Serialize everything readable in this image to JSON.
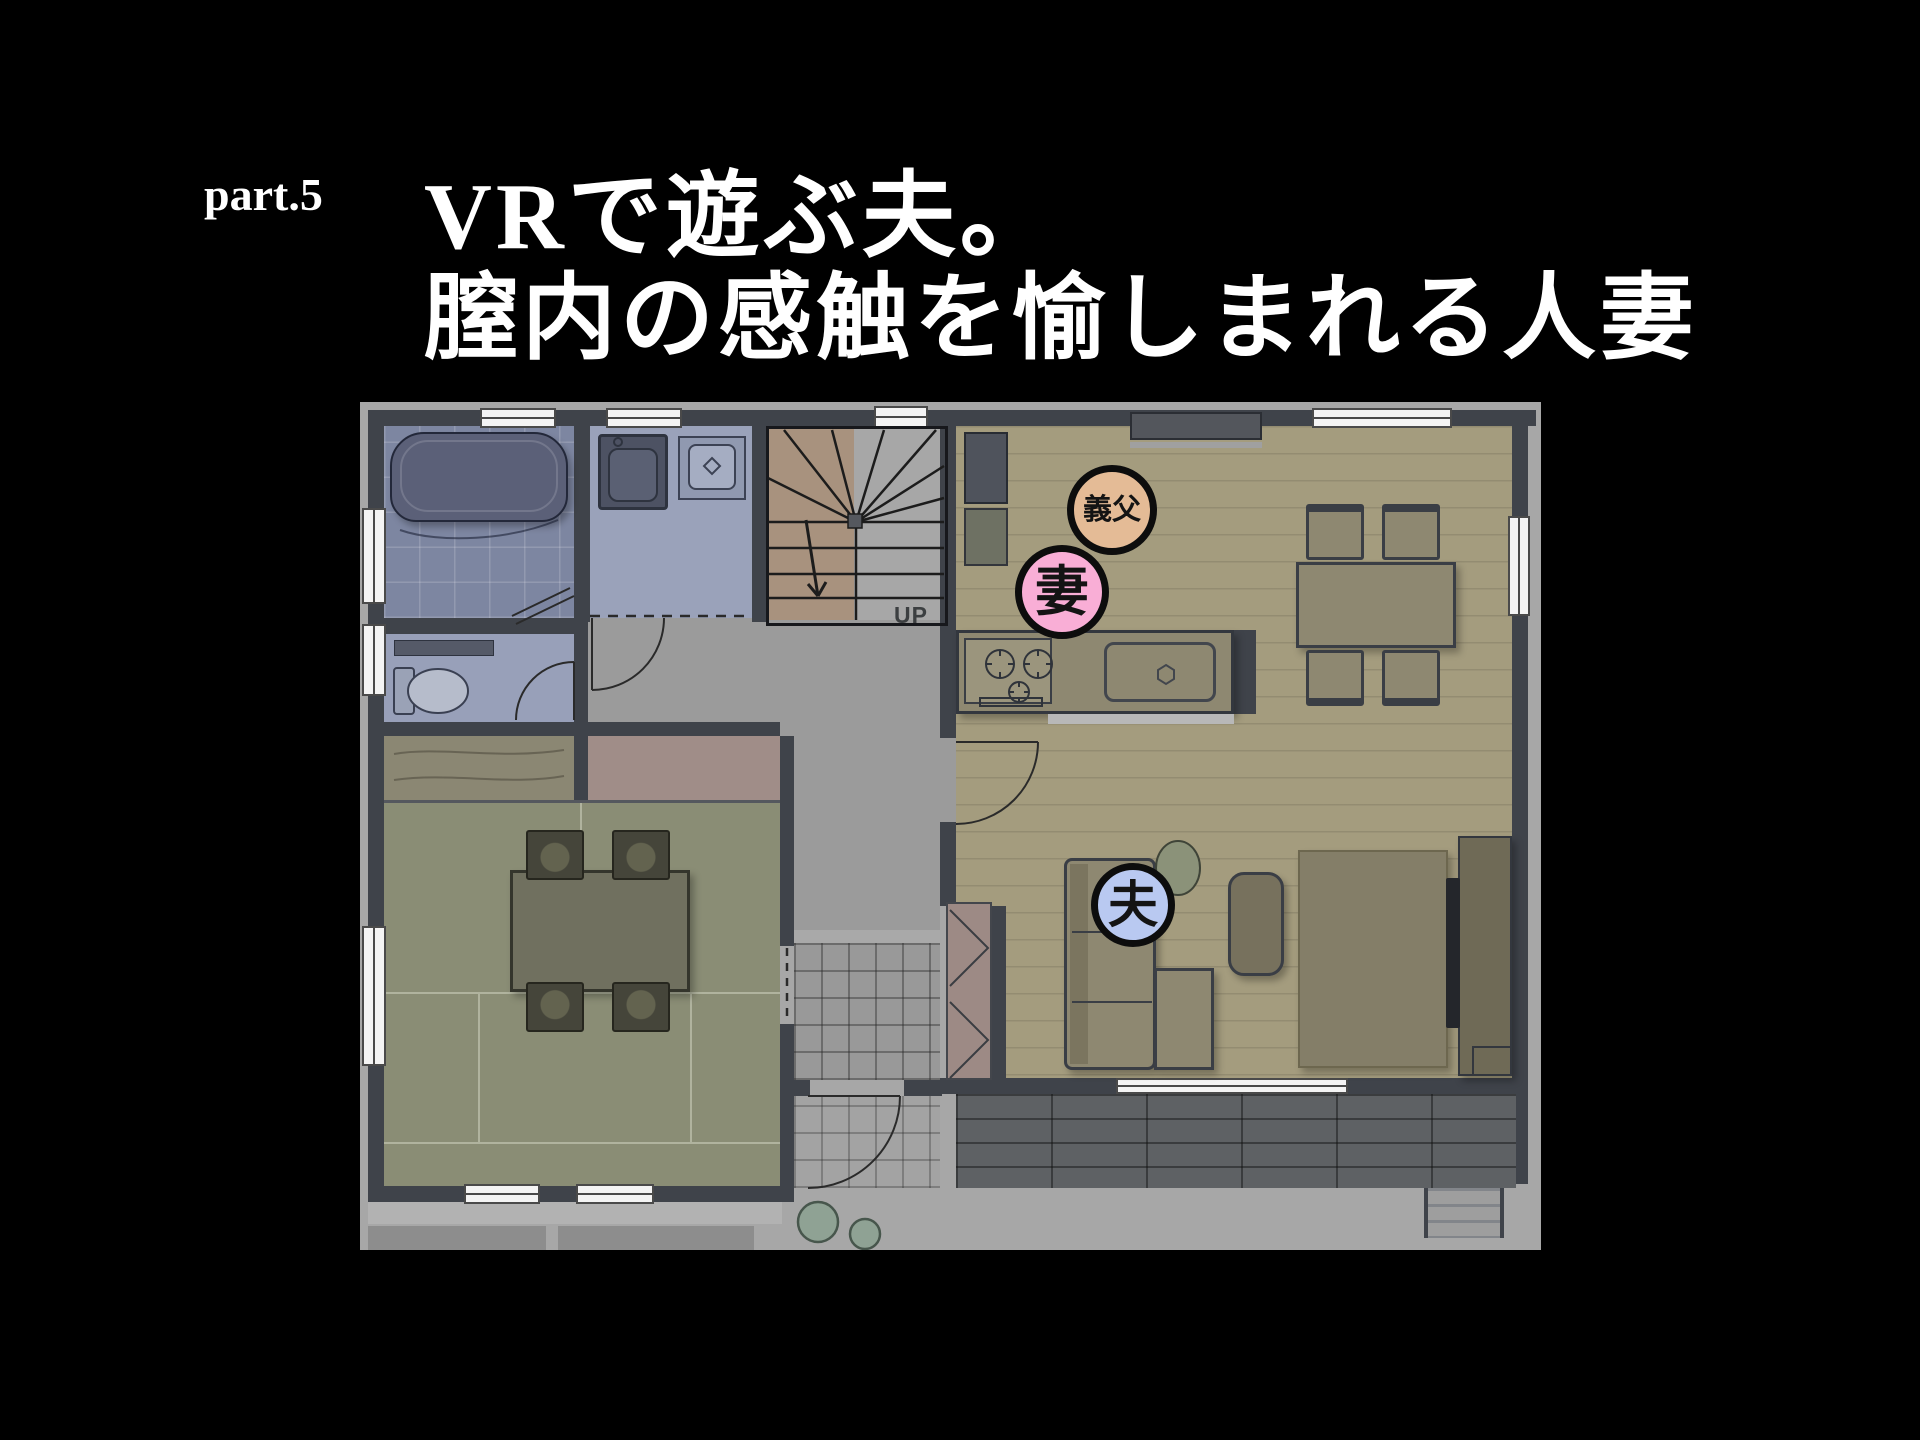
{
  "header": {
    "part_label": "part.5",
    "title_line1": "VRで遊ぶ夫。",
    "title_line2": "膣内の感触を愉しまれる人妻"
  },
  "floor_plan": {
    "stairs_label": "UP",
    "markers": [
      {
        "id": "father-in-law",
        "label": "義父",
        "fill": "#e4bb96",
        "x": 752,
        "y": 108,
        "d": 90,
        "font": 29
      },
      {
        "id": "wife",
        "label": "妻",
        "fill": "#f9aed6",
        "x": 702,
        "y": 190,
        "d": 94,
        "font": 54
      },
      {
        "id": "husband",
        "label": "夫",
        "fill": "#b9c9f1",
        "x": 773,
        "y": 503,
        "d": 84,
        "font": 50
      }
    ]
  },
  "colors": {
    "background": "#000000",
    "title_text": "#ffffff",
    "wall": "#3f434a",
    "ldk_floor": "#a49c7e",
    "tatami_floor": "#8a8d75",
    "bath_floor": "#7d86a1",
    "hall_floor": "#9b9b9b",
    "deck": "#5e6164",
    "marker_border": "#0d0d0d"
  }
}
